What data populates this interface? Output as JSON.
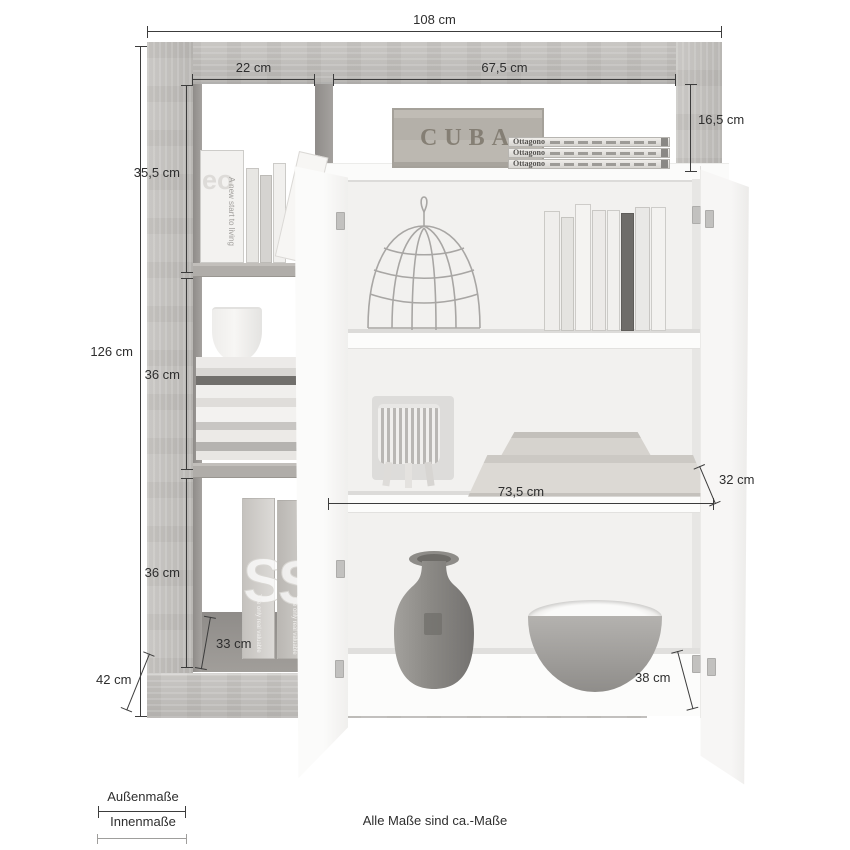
{
  "dims": {
    "width_total": "108 cm",
    "left_column_width": "22 cm",
    "niche_width": "67,5 cm",
    "niche_height": "16,5 cm",
    "section_top_height": "35,5 cm",
    "height_total": "126 cm",
    "section_middle_height": "36 cm",
    "section_bottom_height": "36 cm",
    "left_shelf_depth": "33 cm",
    "base_depth": "42 cm",
    "inner_width": "73,5 cm",
    "shelf_depth": "32 cm",
    "bottom_shelf_depth": "38 cm"
  },
  "legend": {
    "outer_label": "Außenmaße",
    "inner_label": "Innenmaße",
    "footnote": "Alle Maße sind ca.-Maße"
  },
  "props": {
    "crate_label": "CUBA",
    "magazine_title": "Ottagono",
    "spine_text": "A new start to living",
    "cover_letters": "eo",
    "big_letter": "S",
    "tall_book_caption": "The only real valuable"
  },
  "colors": {
    "wood": "#c3c1be",
    "cabinet_white": "#fbfbfa",
    "dimension_line": "#3c3c3c",
    "legend_inner_line": "#9f9e9c"
  }
}
